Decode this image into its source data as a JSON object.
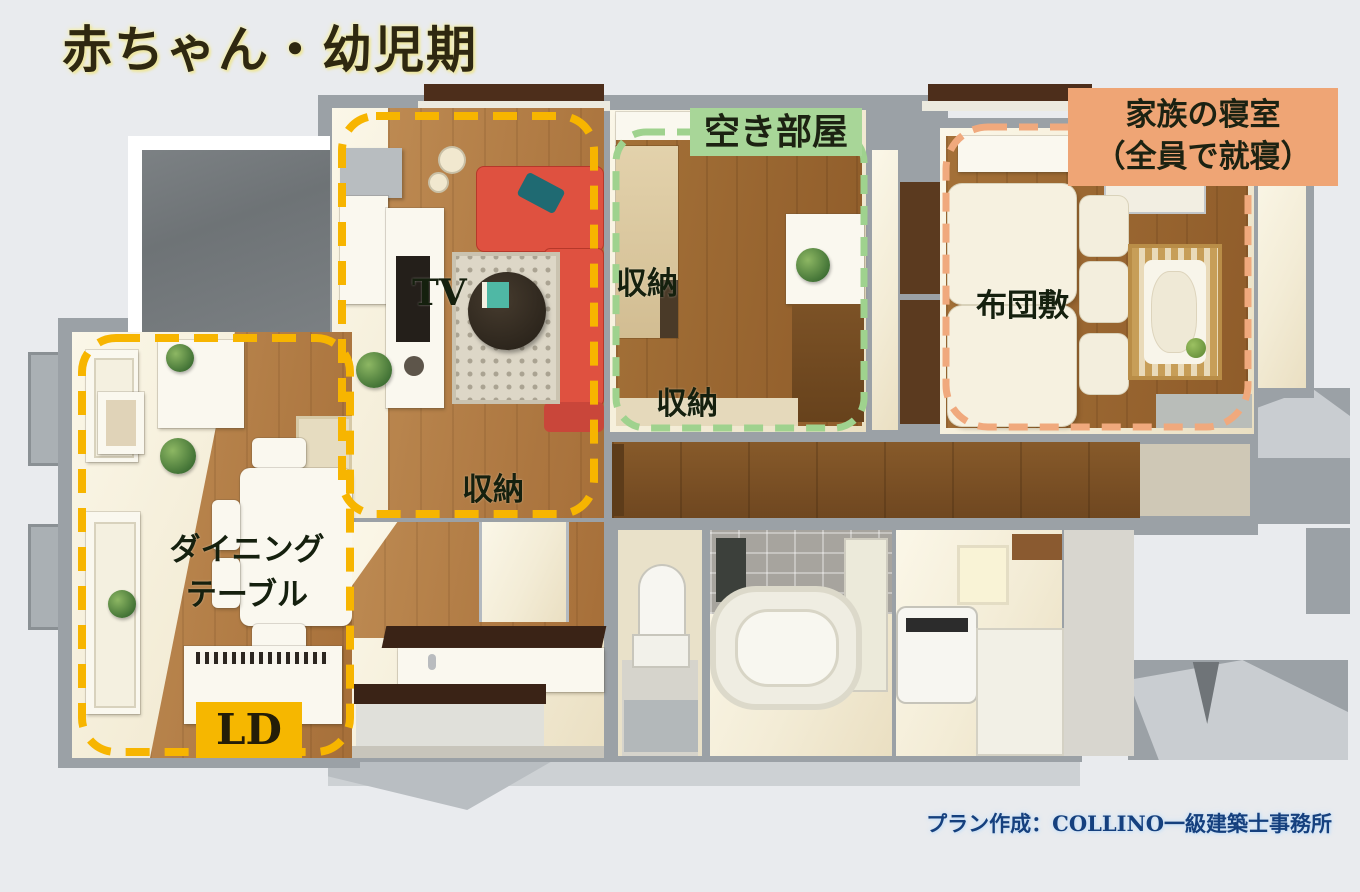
{
  "title": "赤ちゃん・幼児期",
  "labels": {
    "empty_room": "空き部屋",
    "family_bedroom": {
      "line1": "家族の寝室",
      "line2": "（全員で就寝）"
    },
    "tv": "TV",
    "storage": [
      "収納",
      "収納",
      "収納"
    ],
    "futon": "布団敷",
    "dining": {
      "line1": "ダイニング",
      "line2": "テーブル"
    },
    "ld": "LD"
  },
  "credit": "プラン作成：COLLINO一級建築士事務所",
  "colors": {
    "ld_outline": "#f7b500",
    "ld_label_bg": "#f6b700",
    "empty_room_outline": "#9fd28e",
    "empty_room_label_bg": "#a8d698",
    "bedroom_outline": "#f0a97d",
    "bedroom_label_bg": "#efa575",
    "title_text": "#2f2810",
    "credit_text": "#15407e",
    "sofa": "#df5140",
    "wall_gray": "#9ba1a6",
    "wood_floor": "#b08048"
  }
}
